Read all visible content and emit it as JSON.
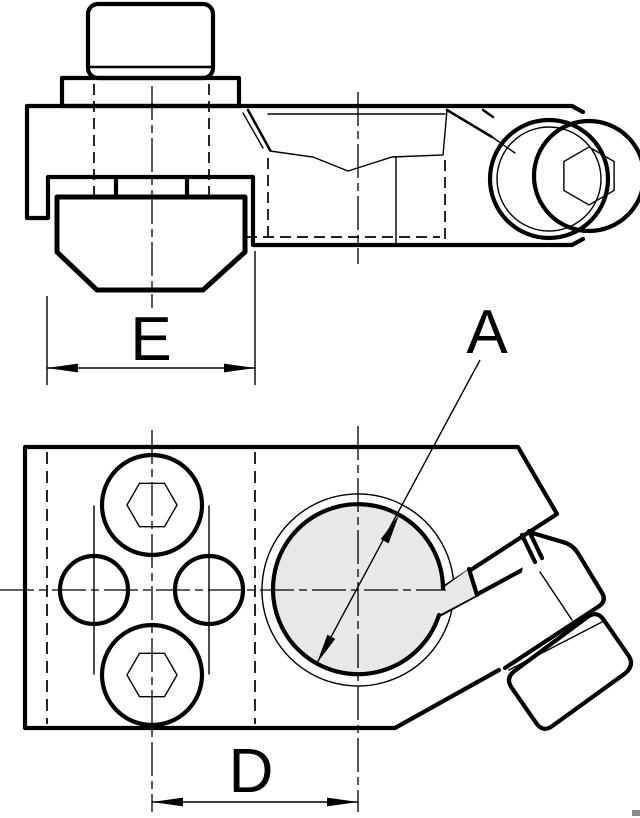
{
  "drawing": {
    "labels": {
      "bore_diameter": "A",
      "hole_spacing": "D",
      "clamp_width": "E"
    },
    "colors": {
      "line": "#000000",
      "hole_fill": "#e8e8e8",
      "background": "#ffffff"
    }
  }
}
